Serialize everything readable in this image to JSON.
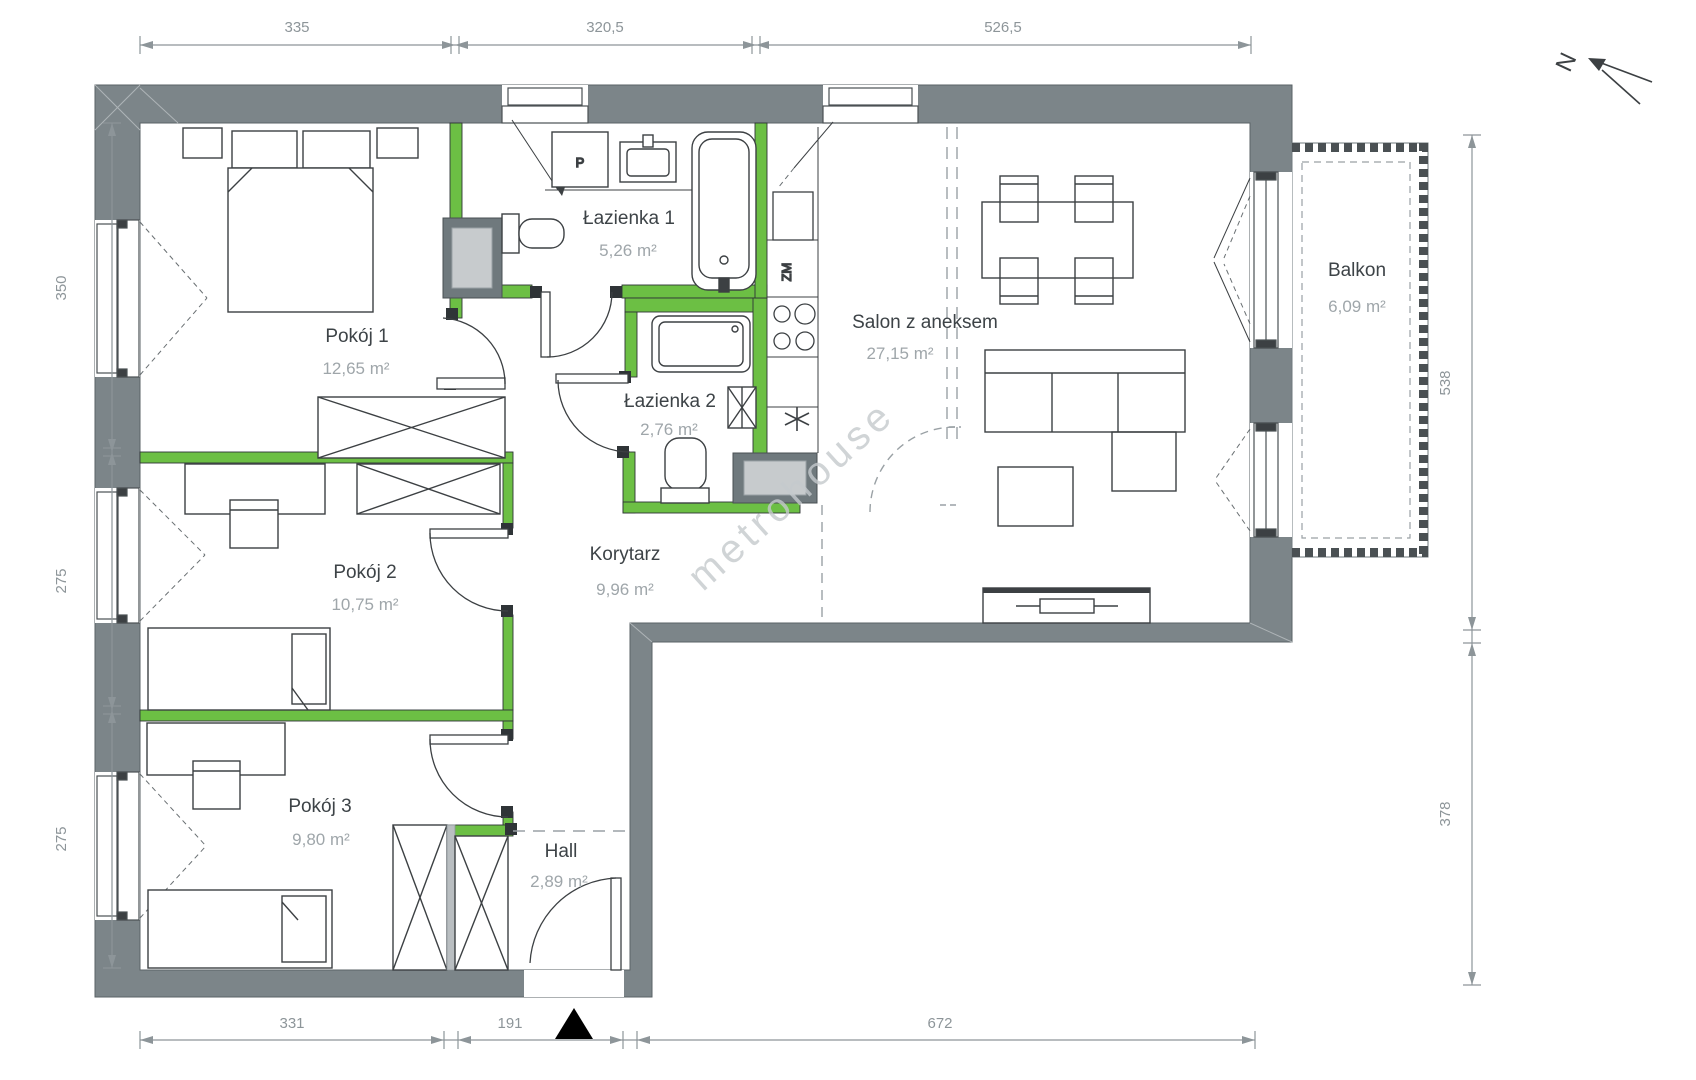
{
  "floorplan": {
    "watermark": "metrohouse",
    "north": "N",
    "rooms": [
      {
        "name": "Pokój 1",
        "area": "12,65 m²"
      },
      {
        "name": "Łazienka 1",
        "area": "5,26 m²"
      },
      {
        "name": "Łazienka 2",
        "area": "2,76 m²"
      },
      {
        "name": "Salon z aneksem",
        "area": "27,15 m²"
      },
      {
        "name": "Balkon",
        "area": "6,09 m²"
      },
      {
        "name": "Pokój 2",
        "area": "10,75 m²"
      },
      {
        "name": "Korytarz",
        "area": "9,96 m²"
      },
      {
        "name": "Pokój 3",
        "area": "9,80 m²"
      },
      {
        "name": "Hall",
        "area": "2,89 m²"
      }
    ],
    "fixtures": {
      "washing_machine": "P",
      "dishwasher": "ZM"
    },
    "dims": {
      "top": [
        "335",
        "320,5",
        "526,5"
      ],
      "left": [
        "350",
        "275",
        "275"
      ],
      "right": [
        "538",
        "378"
      ],
      "bottom": [
        "331",
        "191",
        "672"
      ]
    },
    "colors": {
      "wall": "#7C8589",
      "partition": "#6CBF44",
      "dim_gray": "#8D9599",
      "room_name": "#3D4347",
      "room_area": "#9FA6AA",
      "watermark": "#C5CACD",
      "entrance_marker": "#000000"
    }
  }
}
